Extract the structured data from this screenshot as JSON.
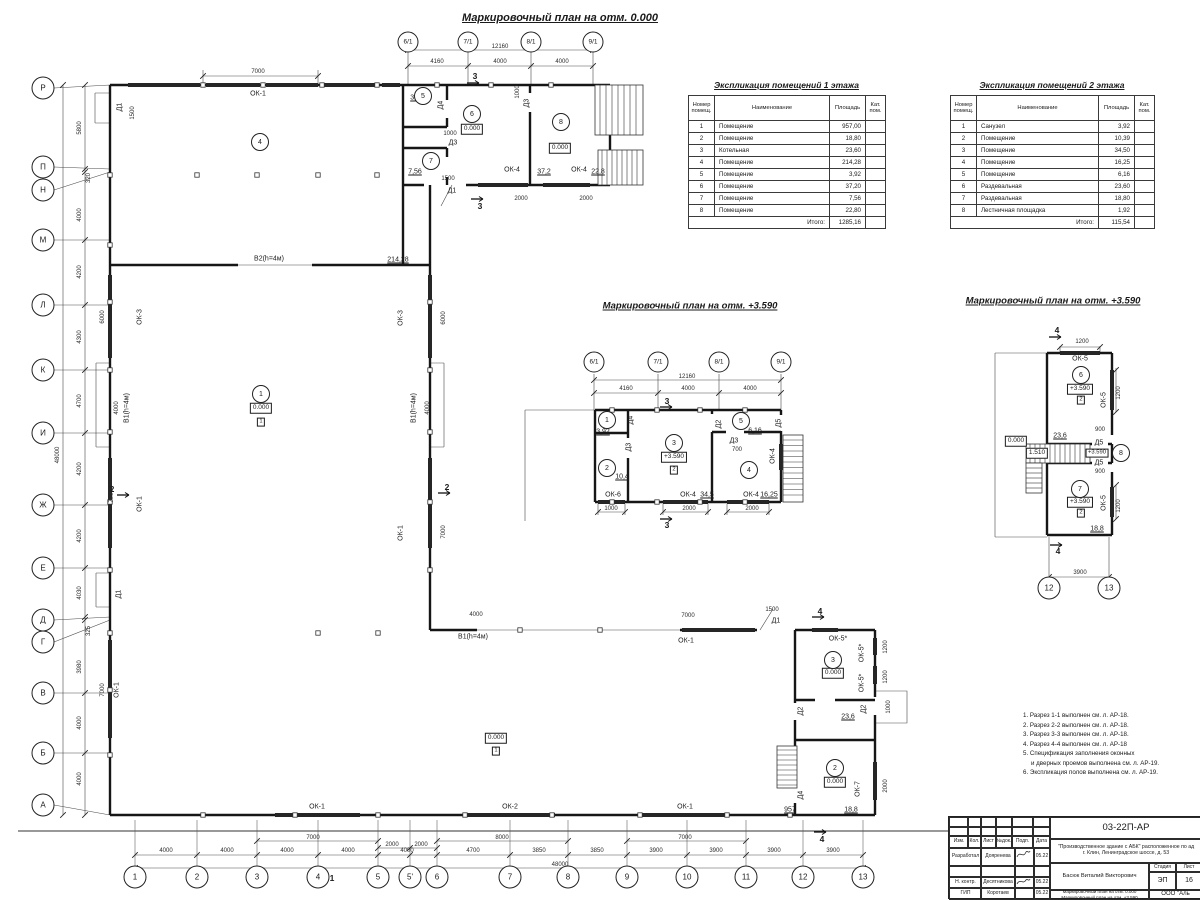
{
  "titles": {
    "main": "Маркировочный план на отм. 0.000",
    "mid": "Маркировочный план на отм. +3.590",
    "right": "Маркировочный план на отм. +3.590"
  },
  "tables": {
    "floor1": {
      "title": "Экспликация помещений 1 этажа",
      "headers": [
        "Номер помещ.",
        "Наименование",
        "Площадь",
        "Кат. пом."
      ],
      "rows": [
        [
          "1",
          "Помещение",
          "957,00"
        ],
        [
          "2",
          "Помещение",
          "18,80"
        ],
        [
          "3",
          "Котельная",
          "23,60"
        ],
        [
          "4",
          "Помещение",
          "214,28"
        ],
        [
          "5",
          "Помещение",
          "3,92"
        ],
        [
          "6",
          "Помещение",
          "37,20"
        ],
        [
          "7",
          "Помещение",
          "7,56"
        ],
        [
          "8",
          "Помещение",
          "22,80"
        ]
      ],
      "total_label": "Итого:",
      "total": "1285,16"
    },
    "floor2": {
      "title": "Экспликация помещений 2 этажа",
      "headers": [
        "Номер помещ.",
        "Наименование",
        "Площадь",
        "Кат. пом."
      ],
      "rows": [
        [
          "1",
          "Санузел",
          "3,92"
        ],
        [
          "2",
          "Помещение",
          "10,39"
        ],
        [
          "3",
          "Помещение",
          "34,50"
        ],
        [
          "4",
          "Помещение",
          "16,25"
        ],
        [
          "5",
          "Помещение",
          "6,16"
        ],
        [
          "6",
          "Раздевальная",
          "23,60"
        ],
        [
          "7",
          "Раздевальная",
          "18,80"
        ],
        [
          "8",
          "Лестничная площадка",
          "1,92"
        ]
      ],
      "total_label": "Итого:",
      "total": "115,54"
    }
  },
  "notes": [
    [
      "1. Разрез 1-1 выполнен см. л. АР-18.",
      0
    ],
    [
      "2. Разрез 2-2 выполнен см. л. АР-18.",
      0
    ],
    [
      "3. Разрез 3-3 выполнен см. л. АР-18.",
      0
    ],
    [
      "4. Разрез 4-4 выполнен см. л. АР-18",
      0
    ],
    [
      "5. Спецификация заполнения оконных",
      0
    ],
    [
      "и дверных проемов выполнена см. л. АР-19.",
      1
    ],
    [
      "6. Экспликация полов выполнена см. л. АР-19.",
      0
    ]
  ],
  "titleblock": {
    "code": "03-22П-АР",
    "project_line1": "\"Производственное здание с АБК\" расположенное по ад",
    "project_line2": "г. Клин, Ленинградское шоссе, д. 53",
    "cols": [
      "Изм.",
      "Кол.",
      "Лист",
      "№док.",
      "Подп.",
      "Дата"
    ],
    "rows": [
      {
        "role": "Разработал",
        "name": "Дояренева",
        "date": "05.22"
      },
      {
        "role": "Н. контр.",
        "name": "Десятникова",
        "date": "05.22"
      },
      {
        "role": "ГИП",
        "name": "Коротаев",
        "date": "05.22"
      }
    ],
    "author": "Басюк Виталий Викторович",
    "stage_label": "Стадия",
    "sheet_label": "Лист",
    "stage": "ЭП",
    "sheet": "16",
    "drawing_title_line1": "Маркировочный план на отм. 0.000",
    "drawing_title_line2": "Маркировочный план на отм. +3.590",
    "company": "ООО \"Аль"
  },
  "bubbles": [
    [
      43,
      88,
      "Р",
      ""
    ],
    [
      43,
      167,
      "П",
      ""
    ],
    [
      43,
      190,
      "Н",
      ""
    ],
    [
      43,
      240,
      "М",
      ""
    ],
    [
      43,
      305,
      "Л",
      ""
    ],
    [
      43,
      370,
      "К",
      ""
    ],
    [
      43,
      433,
      "И",
      ""
    ],
    [
      43,
      505,
      "Ж",
      ""
    ],
    [
      43,
      568,
      "Е",
      ""
    ],
    [
      43,
      620,
      "Д",
      ""
    ],
    [
      43,
      642,
      "Г",
      ""
    ],
    [
      43,
      693,
      "В",
      ""
    ],
    [
      43,
      753,
      "Б",
      ""
    ],
    [
      43,
      805,
      "А",
      ""
    ],
    [
      135,
      877,
      "1",
      ""
    ],
    [
      197,
      877,
      "2",
      ""
    ],
    [
      257,
      877,
      "3",
      ""
    ],
    [
      318,
      877,
      "4",
      ""
    ],
    [
      378,
      877,
      "5",
      ""
    ],
    [
      410,
      877,
      "5'",
      ""
    ],
    [
      437,
      877,
      "6",
      ""
    ],
    [
      510,
      877,
      "7",
      ""
    ],
    [
      568,
      877,
      "8",
      ""
    ],
    [
      627,
      877,
      "9",
      ""
    ],
    [
      687,
      877,
      "10",
      ""
    ],
    [
      746,
      877,
      "11",
      ""
    ],
    [
      803,
      877,
      "12",
      ""
    ],
    [
      863,
      877,
      "13",
      ""
    ],
    [
      1049,
      588,
      "12",
      ""
    ],
    [
      1109,
      588,
      "13",
      ""
    ],
    [
      408,
      42,
      "6/1",
      "gt"
    ],
    [
      468,
      42,
      "7/1",
      "gt"
    ],
    [
      531,
      42,
      "8/1",
      "gt"
    ],
    [
      593,
      42,
      "9/1",
      "gt"
    ],
    [
      594,
      362,
      "6/1",
      "gt"
    ],
    [
      658,
      362,
      "7/1",
      "gt"
    ],
    [
      719,
      362,
      "8/1",
      "gt"
    ],
    [
      781,
      362,
      "9/1",
      "gt"
    ],
    [
      260,
      142,
      "4",
      "room"
    ],
    [
      423,
      96,
      "5",
      "room"
    ],
    [
      472,
      114,
      "6",
      "room"
    ],
    [
      431,
      161,
      "7",
      "room"
    ],
    [
      561,
      122,
      "8",
      "room"
    ],
    [
      261,
      394,
      "1",
      "room"
    ],
    [
      833,
      660,
      "3",
      "room"
    ],
    [
      835,
      768,
      "2",
      "room"
    ],
    [
      607,
      420,
      "1",
      "room"
    ],
    [
      607,
      468,
      "2",
      "room"
    ],
    [
      674,
      443,
      "3",
      "room"
    ],
    [
      749,
      470,
      "4",
      "room"
    ],
    [
      741,
      421,
      "5",
      "room"
    ],
    [
      1081,
      375,
      "6",
      "room"
    ],
    [
      1080,
      489,
      "7",
      "room"
    ],
    [
      1121,
      453,
      "8",
      "room"
    ]
  ],
  "labels": [
    [
      258,
      94,
      "ОК-1",
      ""
    ],
    [
      120,
      107,
      "Д1",
      "rot"
    ],
    [
      133,
      113,
      "1500",
      "dimrot"
    ],
    [
      269,
      259,
      "В2(h=4м)",
      ""
    ],
    [
      398,
      260,
      "214,28",
      "area"
    ],
    [
      417,
      98,
      "3,92",
      "area"
    ],
    [
      441,
      105,
      "Д4",
      "rot"
    ],
    [
      472,
      129,
      "0.000",
      "box"
    ],
    [
      453,
      143,
      "Д3",
      ""
    ],
    [
      450,
      134,
      "1000",
      "dim"
    ],
    [
      415,
      172,
      "7,56",
      "area"
    ],
    [
      512,
      170,
      "ОК-4",
      ""
    ],
    [
      544,
      172,
      "37,2",
      "area"
    ],
    [
      579,
      170,
      "ОК-4",
      ""
    ],
    [
      598,
      172,
      "22,8",
      "area"
    ],
    [
      521,
      199,
      "2000",
      "dim"
    ],
    [
      586,
      199,
      "2000",
      "dim"
    ],
    [
      527,
      103,
      "Д3",
      "rot"
    ],
    [
      518,
      92,
      "1000",
      "dimrot"
    ],
    [
      560,
      148,
      "0.000",
      "box"
    ],
    [
      452,
      191,
      "Д1",
      ""
    ],
    [
      448,
      179,
      "1500",
      "dim"
    ],
    [
      475,
      76,
      "3",
      "sec"
    ],
    [
      480,
      206,
      "3",
      "sec"
    ],
    [
      140,
      317,
      "ОК-3",
      "rot"
    ],
    [
      127,
      408,
      "В1(h=4м)",
      "rot"
    ],
    [
      140,
      504,
      "ОК-1",
      "rot"
    ],
    [
      117,
      690,
      "ОК-1",
      "rot"
    ],
    [
      401,
      318,
      "ОК-3",
      "rot"
    ],
    [
      414,
      408,
      "В1(h=4м)",
      "rot"
    ],
    [
      401,
      533,
      "ОК-1",
      "rot"
    ],
    [
      103,
      317,
      "6000",
      "dimrot"
    ],
    [
      117,
      408,
      "4000",
      "dimrot"
    ],
    [
      112,
      496,
      "7000",
      "dimrot"
    ],
    [
      103,
      690,
      "7000",
      "dimrot"
    ],
    [
      444,
      318,
      "6000",
      "dimrot"
    ],
    [
      428,
      408,
      "4000",
      "dimrot"
    ],
    [
      444,
      532,
      "7000",
      "dimrot"
    ],
    [
      261,
      408,
      "0.000",
      "box"
    ],
    [
      261,
      422,
      "1",
      "boxs"
    ],
    [
      496,
      738,
      "0.000",
      "box"
    ],
    [
      496,
      751,
      "1",
      "boxs"
    ],
    [
      473,
      637,
      "В1(h=4м)",
      ""
    ],
    [
      686,
      641,
      "ОК-1",
      ""
    ],
    [
      476,
      615,
      "4000",
      "dim"
    ],
    [
      688,
      616,
      "7000",
      "dim"
    ],
    [
      776,
      621,
      "Д1",
      ""
    ],
    [
      772,
      610,
      "1500",
      "dim"
    ],
    [
      820,
      611,
      "4",
      "sec"
    ],
    [
      822,
      839,
      "4",
      "sec"
    ],
    [
      838,
      639,
      "ОК-5*",
      ""
    ],
    [
      862,
      653,
      "ОК-5*",
      "rot"
    ],
    [
      862,
      683,
      "ОК-5*",
      "rot"
    ],
    [
      833,
      673,
      "0.000",
      "box"
    ],
    [
      848,
      717,
      "23,6",
      "area"
    ],
    [
      801,
      711,
      "Д2",
      "rot"
    ],
    [
      864,
      709,
      "Д2",
      "rot"
    ],
    [
      886,
      647,
      "1200",
      "dimrot"
    ],
    [
      886,
      677,
      "1200",
      "dimrot"
    ],
    [
      889,
      707,
      "1000",
      "dimrot"
    ],
    [
      835,
      782,
      "0.000",
      "box"
    ],
    [
      858,
      789,
      "ОК-7",
      "rot"
    ],
    [
      886,
      786,
      "2000",
      "dimrot"
    ],
    [
      801,
      795,
      "Д4",
      "rot"
    ],
    [
      790,
      810,
      "957",
      "area"
    ],
    [
      851,
      810,
      "18,8",
      "area"
    ],
    [
      317,
      807,
      "ОК-1",
      ""
    ],
    [
      510,
      807,
      "ОК-2",
      ""
    ],
    [
      685,
      807,
      "ОК-1",
      ""
    ],
    [
      112,
      489,
      "2",
      "sec"
    ],
    [
      447,
      487,
      "2",
      "sec"
    ],
    [
      119,
      594,
      "Д1",
      "rot"
    ],
    [
      258,
      72,
      "7000",
      "dim"
    ],
    [
      500,
      47,
      "12160",
      "dim"
    ],
    [
      437,
      62,
      "4160",
      "dim"
    ],
    [
      500,
      62,
      "4000",
      "dim"
    ],
    [
      562,
      62,
      "4000",
      "dim"
    ],
    [
      80,
      128,
      "5800",
      "dimrot"
    ],
    [
      89,
      178,
      "320",
      "dimrot"
    ],
    [
      80,
      215,
      "4000",
      "dimrot"
    ],
    [
      80,
      272,
      "4200",
      "dimrot"
    ],
    [
      80,
      337,
      "4300",
      "dimrot"
    ],
    [
      80,
      401,
      "4700",
      "dimrot"
    ],
    [
      80,
      469,
      "4200",
      "dimrot"
    ],
    [
      80,
      536,
      "4200",
      "dimrot"
    ],
    [
      80,
      593,
      "4030",
      "dimrot"
    ],
    [
      89,
      631,
      "325",
      "dimrot"
    ],
    [
      80,
      667,
      "3980",
      "dimrot"
    ],
    [
      80,
      723,
      "4000",
      "dimrot"
    ],
    [
      80,
      779,
      "4000",
      "dimrot"
    ],
    [
      58,
      455,
      "48000",
      "dimrot"
    ],
    [
      166,
      851,
      "4000",
      "dim"
    ],
    [
      227,
      851,
      "4000",
      "dim"
    ],
    [
      287,
      851,
      "4000",
      "dim"
    ],
    [
      348,
      851,
      "4000",
      "dim"
    ],
    [
      407,
      851,
      "4000",
      "dim"
    ],
    [
      473,
      851,
      "4700",
      "dim"
    ],
    [
      539,
      851,
      "3850",
      "dim"
    ],
    [
      597,
      851,
      "3850",
      "dim"
    ],
    [
      656,
      851,
      "3900",
      "dim"
    ],
    [
      716,
      851,
      "3900",
      "dim"
    ],
    [
      774,
      851,
      "3900",
      "dim"
    ],
    [
      833,
      851,
      "3900",
      "dim"
    ],
    [
      392,
      845,
      "2000",
      "dim"
    ],
    [
      421,
      845,
      "2000",
      "dim"
    ],
    [
      313,
      838,
      "7000",
      "dim"
    ],
    [
      502,
      838,
      "8000",
      "dim"
    ],
    [
      685,
      838,
      "7000",
      "dim"
    ],
    [
      560,
      865,
      "48000",
      "dim"
    ],
    [
      332,
      878,
      "1",
      "sec"
    ],
    [
      687,
      377,
      "12160",
      "dim"
    ],
    [
      626,
      389,
      "4160",
      "dim"
    ],
    [
      688,
      389,
      "4000",
      "dim"
    ],
    [
      750,
      389,
      "4000",
      "dim"
    ],
    [
      667,
      401,
      "3",
      "sec"
    ],
    [
      667,
      525,
      "3",
      "sec"
    ],
    [
      603,
      432,
      "3,92",
      "area"
    ],
    [
      631,
      420,
      "Д4",
      "rot"
    ],
    [
      629,
      447,
      "Д3",
      "rot"
    ],
    [
      622,
      477,
      "10,4",
      "area"
    ],
    [
      613,
      495,
      "ОК-6",
      ""
    ],
    [
      674,
      457,
      "+3.590",
      "box"
    ],
    [
      674,
      470,
      "2",
      "boxs"
    ],
    [
      688,
      495,
      "ОК-4",
      ""
    ],
    [
      707,
      495,
      "34,5",
      "area"
    ],
    [
      719,
      424,
      "Д2",
      "rot"
    ],
    [
      734,
      441,
      "Д3",
      ""
    ],
    [
      737,
      450,
      "700",
      "dim"
    ],
    [
      755,
      431,
      "6,16",
      "area"
    ],
    [
      779,
      423,
      "Д5",
      "rot"
    ],
    [
      751,
      495,
      "ОК-4",
      ""
    ],
    [
      769,
      495,
      "16,25",
      "area"
    ],
    [
      773,
      456,
      "ОК-4",
      "rot"
    ],
    [
      611,
      509,
      "1000",
      "dim"
    ],
    [
      689,
      509,
      "2000",
      "dim"
    ],
    [
      752,
      509,
      "2000",
      "dim"
    ],
    [
      1057,
      330,
      "4",
      "sec"
    ],
    [
      1058,
      551,
      "4",
      "sec"
    ],
    [
      1082,
      342,
      "1200",
      "dim"
    ],
    [
      1080,
      359,
      "ОК-5",
      ""
    ],
    [
      1080,
      389,
      "+3.590",
      "box"
    ],
    [
      1081,
      400,
      "2",
      "boxs"
    ],
    [
      1104,
      400,
      "ОК-5",
      "rot"
    ],
    [
      1119,
      393,
      "1200",
      "dimrot"
    ],
    [
      1016,
      441,
      "0.000",
      "box"
    ],
    [
      1060,
      436,
      "23,6",
      "area"
    ],
    [
      1037,
      453,
      "1.510",
      "box"
    ],
    [
      1099,
      443,
      "Д5",
      ""
    ],
    [
      1097,
      453,
      "+3.590",
      "boxs"
    ],
    [
      1099,
      463,
      "Д5",
      ""
    ],
    [
      1100,
      430,
      "900",
      "dim"
    ],
    [
      1100,
      472,
      "900",
      "dim"
    ],
    [
      1080,
      502,
      "+3.590",
      "box"
    ],
    [
      1081,
      513,
      "2",
      "boxs"
    ],
    [
      1104,
      503,
      "ОК-5",
      "rot"
    ],
    [
      1119,
      506,
      "1200",
      "dimrot"
    ],
    [
      1097,
      529,
      "18,8",
      "area"
    ],
    [
      1080,
      573,
      "3900",
      "dim"
    ]
  ]
}
